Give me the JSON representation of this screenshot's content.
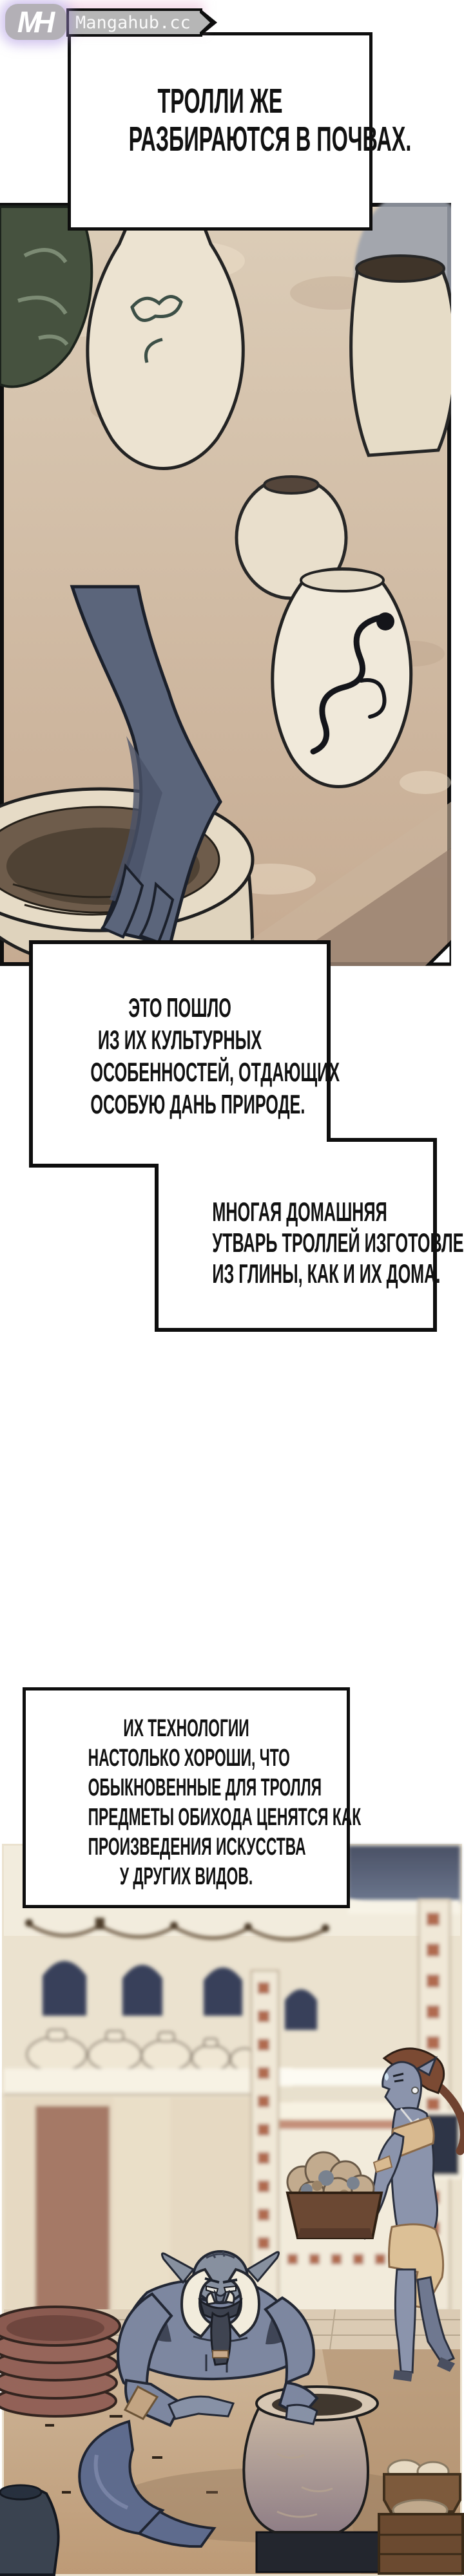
{
  "site": {
    "monogram": "MH",
    "name": "Mangahub.cc"
  },
  "captions": [
    {
      "id": "caption-1",
      "lines": [
        "ТРОЛЛИ ЖЕ",
        "РАЗБИРАЮТСЯ В ПОЧВАХ."
      ]
    },
    {
      "id": "caption-2",
      "lines": [
        "ЭТО ПОШЛО",
        "ИЗ ИХ КУЛЬТУРНЫХ",
        "ОСОБЕННОСТЕЙ, ОТДАЮЩИХ",
        "ОСОБУЮ ДАНЬ ПРИРОДЕ."
      ]
    },
    {
      "id": "caption-3",
      "lines": [
        "МНОГАЯ ДОМАШНЯЯ",
        "УТВАРЬ ТРОЛЛЕЙ ИЗГОТОВЛЕНА",
        "ИЗ ГЛИНЫ, КАК И ИХ ДОМА."
      ]
    },
    {
      "id": "caption-4",
      "lines": [
        "ИХ ТЕХНОЛОГИИ",
        "НАСТОЛЬКО ХОРОШИ, ЧТО",
        "ОБЫКНОВЕННЫЕ ДЛЯ ТРОЛЛЯ",
        "ПРЕДМЕТЫ ОБИХОДА ЦЕНЯТСЯ КАК",
        "ПРОИЗВЕДЕНИЯ ИСКУССТВА",
        "У ДРУГИХ ВИДОВ."
      ]
    }
  ],
  "panels": [
    {
      "id": "panel-1",
      "alt": "Close-up of clay pottery vases; a grey-blue troll limb kneads clay inside a large pot"
    },
    {
      "id": "panel-2",
      "alt": "Troll pottery workshop: horned troll shapes a pot; troll woman carries a tray of clay; stacked plates and jars"
    }
  ],
  "colors": {
    "caption_border": "#0e0e0e",
    "caption_bg": "#ffffff",
    "logo_badge": "#b3b0b6",
    "logo_glow": "#ac94e0",
    "panel1_bg": "#d5c3ac",
    "panel2_wall": "#ebe2cf",
    "troll_skin": "#7d87a0",
    "clay_pot": "#c9b7a3",
    "plates": "#926157",
    "window": "#39415a",
    "pillar_red": "#b06a50"
  }
}
